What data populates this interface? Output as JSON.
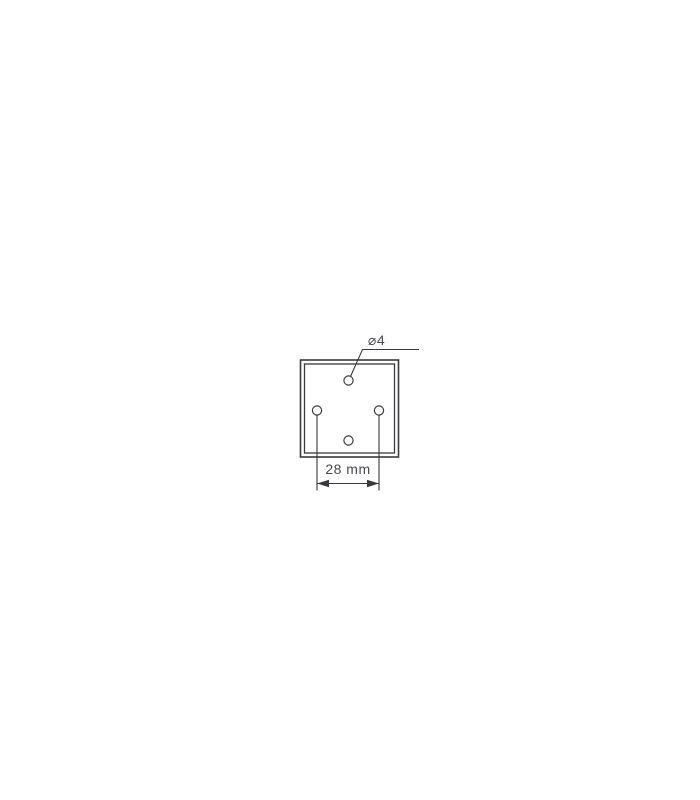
{
  "page": {
    "background": "#ffffff"
  },
  "diagram": {
    "labels": {
      "hole_diameter": "⌀4",
      "hole_spacing": "28 mm"
    },
    "colors": {
      "line": "#3a3a3e",
      "text": "#4a4a4e"
    }
  }
}
